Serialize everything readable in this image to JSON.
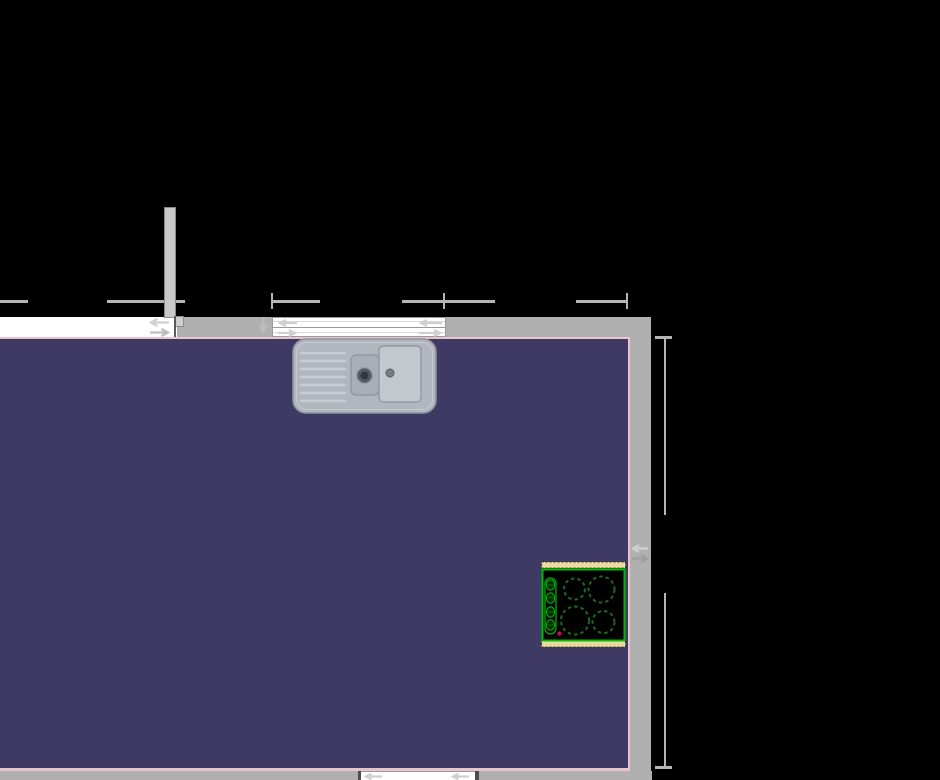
{
  "canvas": {
    "background": "#000000"
  },
  "room": {
    "floor_color": "#3e3a64",
    "outline_color": "#eac3cd",
    "wall_color": "#b0b0b0",
    "partition_fill": "#c8c8c8",
    "partition_border": "#8a8a8a"
  },
  "dimensions": {
    "line_color": "#b5b5b5",
    "labels_visible": ""
  },
  "window": {
    "fill": "#ffffff",
    "frame_color": "#9a9a9a",
    "end_post_dark": "#4c4c4c"
  },
  "handles": {
    "light": "#cfcfcf",
    "mid": "#bdbdbd",
    "dark": "#9e9e9e"
  },
  "sink": {
    "label": "double-bowl-sink-with-drainer",
    "body": "#b1b6bf",
    "edge": "#8e939b",
    "rim": "#c9cdd3",
    "bowl_small": "#aaafb7",
    "bowl_large": "#c3c7ce",
    "drain_dark": "#33383e",
    "drain_mid": "#575c62",
    "drain_small": "#7a7f86"
  },
  "hob": {
    "label": "four-burner-hob",
    "surface": "#000000",
    "frame": "#00bb00",
    "burner": "#1c6b1c",
    "knob": "#00aa00",
    "knob_fill": "#0a2a0a",
    "trim": "#ead9a1",
    "trim_border": "#3a3a10",
    "indicator": "#dd0066"
  }
}
